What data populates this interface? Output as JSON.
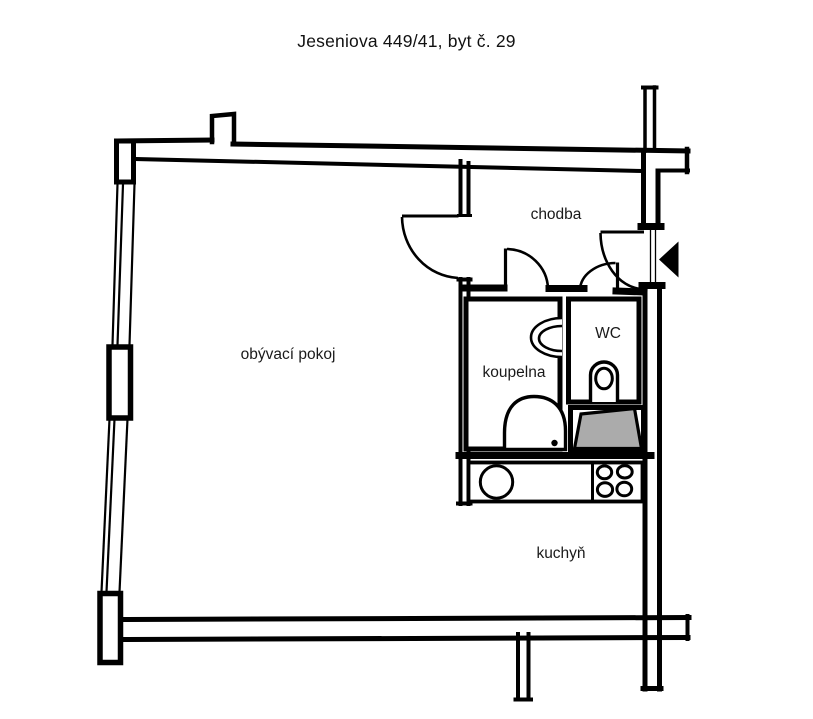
{
  "title": "Jeseniova 449/41, byt č. 29",
  "rooms": {
    "living_room": "obývací pokoj",
    "hallway": "chodba",
    "bathroom": "koupelna",
    "wc": "WC",
    "kitchen": "kuchyň"
  },
  "fixtures": {
    "entrance_marker": "entrance-arrow",
    "bathtub": "bathtub",
    "washbasin": "washbasin",
    "toilet": "toilet",
    "kitchen_sink": "kitchen-sink",
    "stove": "stove-burners",
    "shaded_unit": "shaded-closet"
  },
  "colors": {
    "wall": "#000000",
    "background": "#ffffff",
    "shaded_fill": "#ababab",
    "text": "#1a1a1a"
  }
}
